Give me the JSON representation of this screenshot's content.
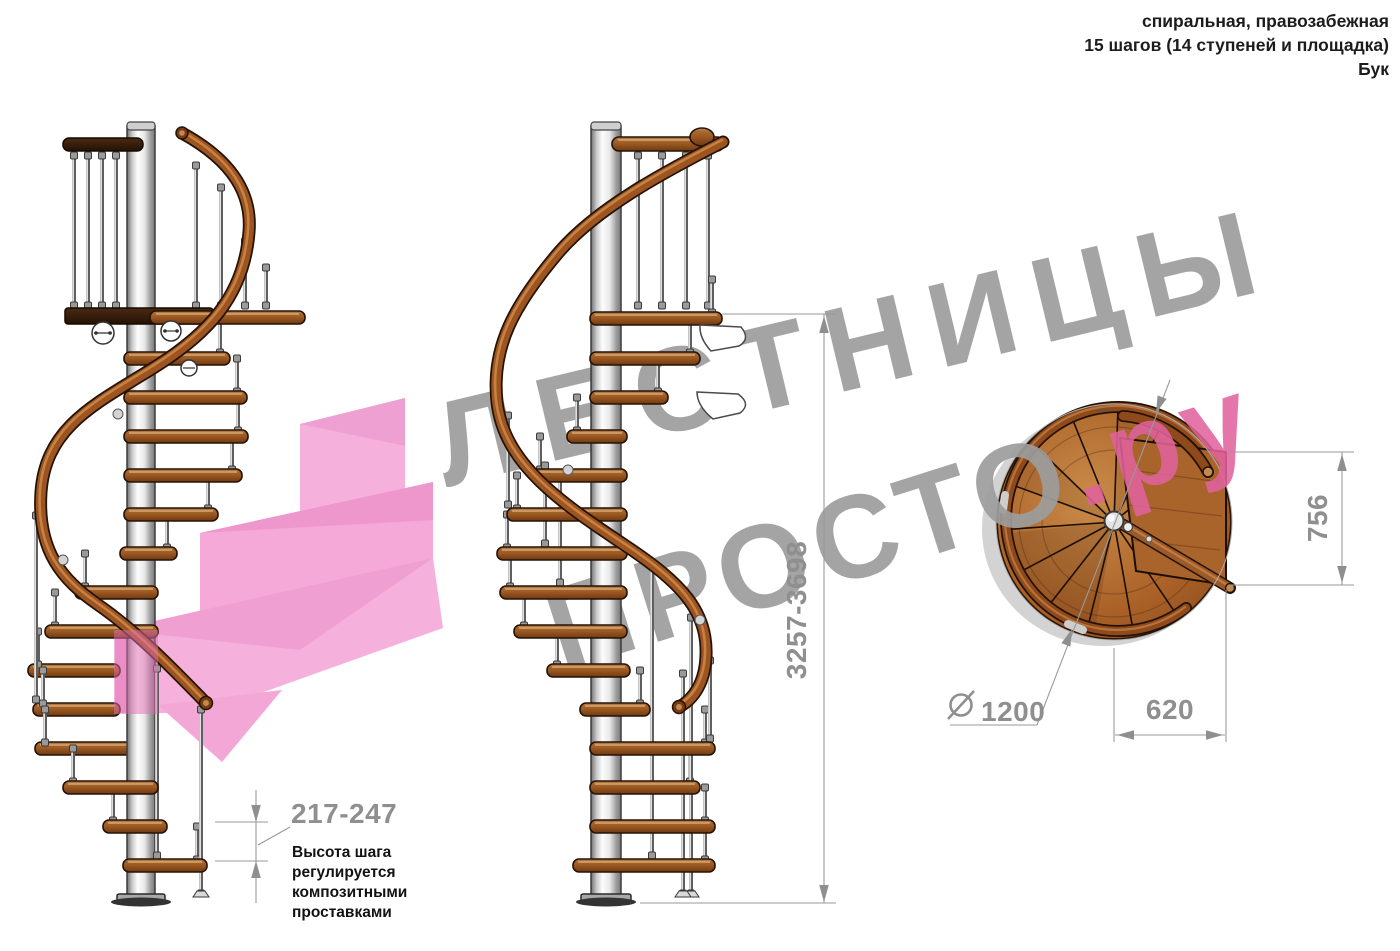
{
  "header": {
    "line1": "спиральная, правозабежная",
    "line2": "15 шагов (14 ступеней и площадка)",
    "line3": "Бук"
  },
  "watermark": {
    "word1": "ЛЕСТНИЦЫ",
    "word2": "ПРОСТО",
    "suffix": ".ру",
    "color_gray": "#9d9d9d",
    "color_pink": "#e0639c"
  },
  "dimensions": {
    "total_height": "3257-3698",
    "landing_depth": "756",
    "landing_width": "620",
    "diameter_value": "1200",
    "diameter_symbol": "⌀",
    "step_height": "217-247"
  },
  "note": {
    "line1": "Высота шага",
    "line2": "регулируется",
    "line3": "композитными",
    "line4": "проставками"
  },
  "accent_colors": {
    "wood": "#9c5420",
    "pink_arrow": "#f4a9d8",
    "dimension_gray": "#8f8f8f"
  }
}
